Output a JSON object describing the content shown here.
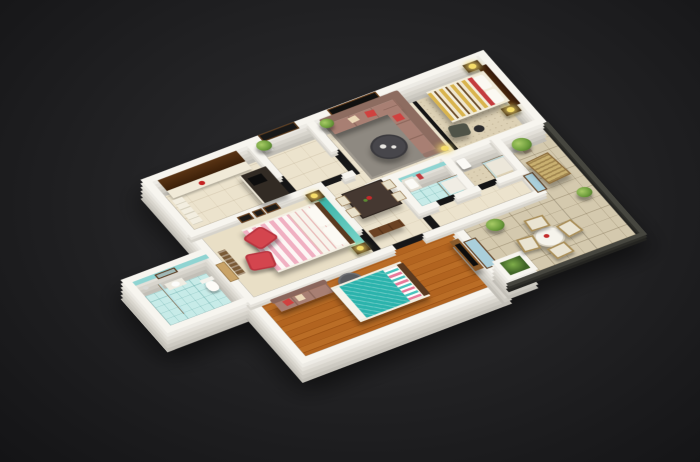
{
  "scene": {
    "type": "3d-floor-plan-render",
    "view": "isometric-dollhouse-cutaway",
    "background": "dark-charcoal-vignette"
  },
  "palette": {
    "bg-outer": "#141416",
    "bg-mid": "#222224",
    "bg-center": "#2e2e30",
    "wall": "#f7f5ef",
    "floor-cream": "#ece3cd",
    "floor-beige": "#ddd1b5",
    "wood-dark": "#5b3a20",
    "cabinet-brown": "#4e2d12",
    "counter-dark": "#322b24",
    "teal-tile": "#c7ebe8",
    "teal-deep": "#8fd4d2",
    "teal-accent": "#3db4ab",
    "teal-duvet": "#2bb3ac",
    "pink-stripe": "#f0b0c2",
    "duvet-yellow": "#d9b44e",
    "red-accent": "#d0413f",
    "sofa-mauve": "#a87f73",
    "sofa-dark": "#8d6c60",
    "rug-gray": "#8e8981",
    "table-dark": "#453831",
    "ottoman-gray": "#595a5e",
    "lamp-yellow": "#f5dc6a",
    "plant-green": "#6f9e3e",
    "terrace-tile": "#d4c9ae",
    "wicker": "#a98e58",
    "glass-blue": "#aacfdb",
    "tv-black": "#0d0d0d"
  },
  "rooms": [
    {
      "id": "kitchen",
      "name": "Kitchen",
      "floor": "cream tile",
      "furniture": [
        "dark upper cabinets",
        "light counter run",
        "dark L-counter",
        "stove",
        "red kettle"
      ]
    },
    {
      "id": "foyer",
      "name": "Entrance Foyer",
      "floor": "cream tile",
      "furniture": [
        "entry door",
        "potted plant"
      ]
    },
    {
      "id": "living-room",
      "name": "Living Room",
      "floor": "cream tile with gray rug",
      "furniture": [
        "mauve L-sofa",
        "red cushions",
        "round coffee table",
        "wall art in wood frame",
        "floor lamp"
      ]
    },
    {
      "id": "bedroom-2",
      "name": "Bedroom 2",
      "floor": "beige carpet",
      "furniture": [
        "double bed with yellow wave duvet",
        "red pillow band",
        "dark wood headboard panel",
        "two nightstands with yellow lamps",
        "dark armchair",
        "ottoman"
      ]
    },
    {
      "id": "master-bedroom",
      "name": "Master Bedroom",
      "floor": "cream carpet",
      "furniture": [
        "double bed with pink striped duvet",
        "teal accent headboard wall",
        "two red armchairs",
        "two nightstands with lamps",
        "wall frames",
        "wardrobe shelving"
      ]
    },
    {
      "id": "bathroom-1",
      "name": "Bathroom 1",
      "floor": "teal tile",
      "furniture": [
        "toilet",
        "sink counter",
        "mirror",
        "glass shower partition"
      ]
    },
    {
      "id": "dining",
      "name": "Dining Area",
      "floor": "cream tile",
      "furniture": [
        "dark dining table",
        "four chairs",
        "centerpiece",
        "hall sideboard"
      ]
    },
    {
      "id": "bathroom-2",
      "name": "Bathroom 2",
      "floor": "teal tile",
      "furniture": [
        "sink",
        "glass shower",
        "red towel"
      ]
    },
    {
      "id": "bathroom-3",
      "name": "Bathroom 3",
      "floor": "beige tile",
      "furniture": [
        "sink",
        "glass shower"
      ]
    },
    {
      "id": "bedroom-3",
      "name": "Bedroom 3",
      "floor": "hardwood",
      "furniture": [
        "double bed with teal duvet",
        "striped pillows",
        "sofa with red cushion",
        "round gray ottoman",
        "tv cabinet",
        "glass terrace door"
      ]
    },
    {
      "id": "terrace",
      "name": "Balcony Terrace",
      "floor": "stone tile",
      "furniture": [
        "round cafe table",
        "four wicker chairs",
        "lounge chair",
        "white planter box",
        "potted plants",
        "dark railing"
      ]
    }
  ]
}
